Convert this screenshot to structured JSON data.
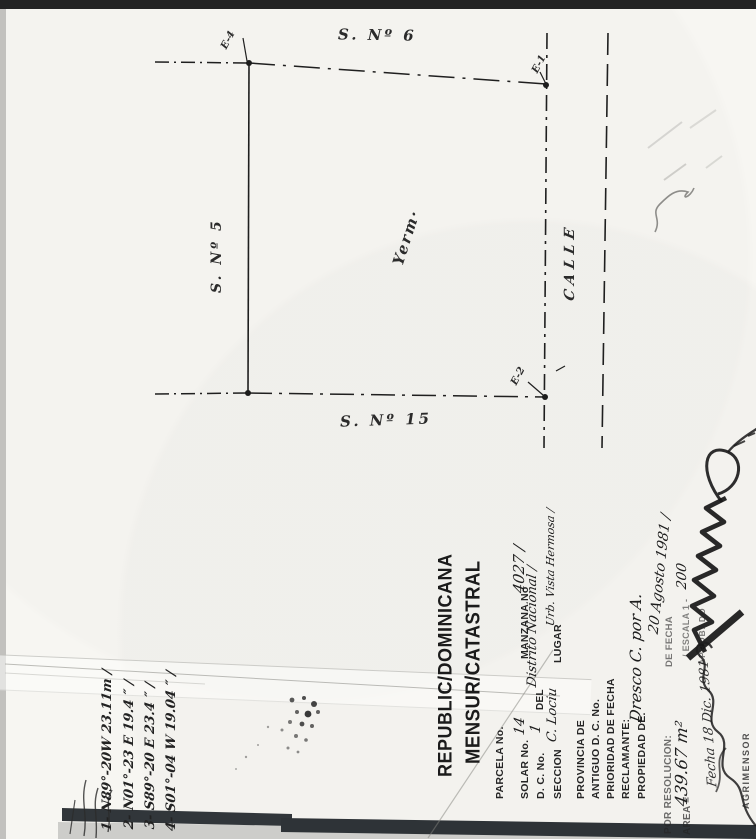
{
  "colors": {
    "paper": "#f7f6f2",
    "ink": "#1f1f1f",
    "scan_band_dark": "#31363a",
    "scan_gray": "#cdcdca"
  },
  "plan": {
    "label_top_street": "S. Nº 6",
    "label_left_street": "S. Nº 5",
    "label_bottom_street": "S. Nº 15",
    "label_right_street": "CALLE",
    "label_parcel": "Yerm·",
    "corner_top_left": "E-4",
    "corner_top_right": "E-1",
    "corner_bottom_right": "E-2"
  },
  "form": {
    "title_line1": "REPUBLIC/DOMINICANA",
    "title_line2": "MENSUR/CATASTRAL",
    "parcela_label": "PARCELA No.",
    "solar_label": "SOLAR No.",
    "solar_value": "14",
    "manzana_label": "MANZANA No",
    "manzana_value": "4027 /",
    "dc_label": "D. C. No.",
    "dc_value": "1",
    "del_label": "DEL",
    "del_value": "Distrito Nacional /",
    "seccion_label": "SECCION",
    "seccion_value": "C. Lociu",
    "lugar_label": "LUGAR",
    "lugar_value": "Urb. Vista Hermosa /",
    "provincia_label": "PROVINCIA DE",
    "antiguo_label": "ANTIGUO D. C. No.",
    "prioridad_label": "PRIORIDAD DE FECHA",
    "reclamante_label": "RECLAMANTE:",
    "propiedad_label": "PROPIEDAD DE.",
    "propiedad_value": "Dresco C. por A.",
    "resolucion_label": "POR RESOLUCION:",
    "defecha_label": "DE FECHA",
    "defecha_value": "20 Agosto 1981 /",
    "area_label": "AREA =",
    "area_value": "439.67 m²",
    "escala_label": "/ ESCALA 1 -",
    "escala_value": "200",
    "aprobado_label": "APROBADO",
    "fecha_firma_value": "Fecha 18 Dic. 1981",
    "agrimensor_label": "AGRIMENSOR"
  },
  "survey_notes": {
    "lines": [
      "1- N89°-20W  23.11m /",
      "2- N01°-23 E  19.4 ″ /",
      "3- S89°-20 E  23.4 ″ /",
      "4- S01°-04 W  19.04 ″ /"
    ]
  }
}
